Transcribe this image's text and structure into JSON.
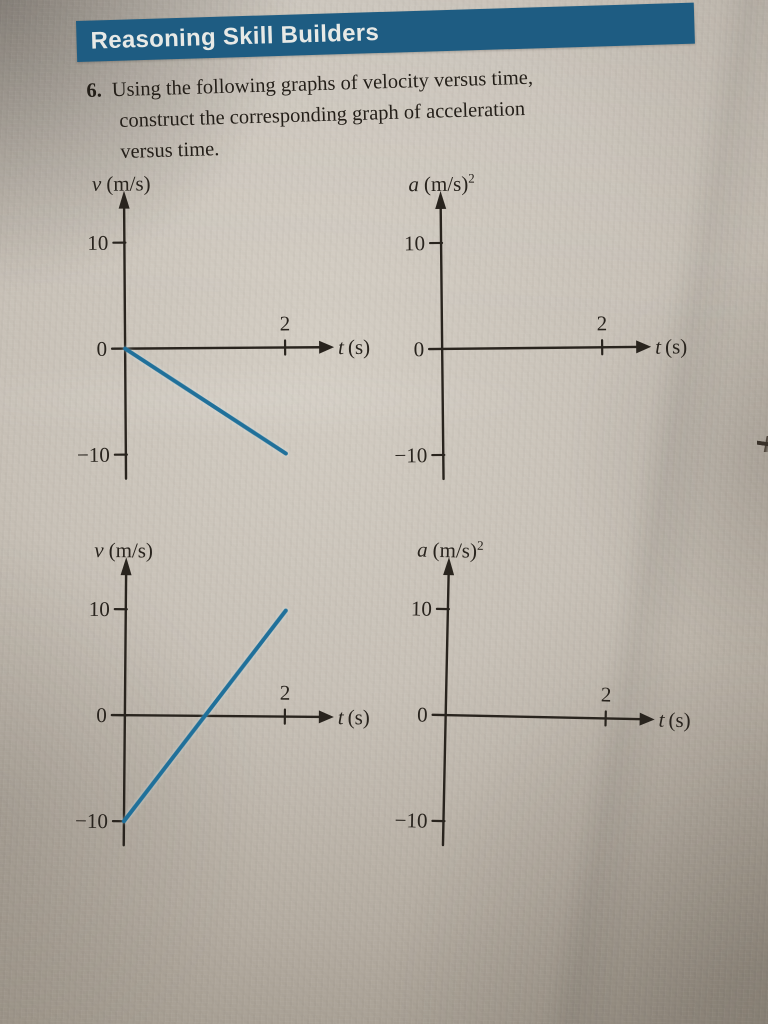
{
  "header": {
    "title": "Reasoning Skill Builders"
  },
  "problem": {
    "number": "6.",
    "text_lines": [
      "Using the following graphs of velocity versus time,",
      "construct the corresponding graph of acceleration",
      "versus time."
    ]
  },
  "colors": {
    "banner": "#1e5c82",
    "plot_line": "#20709a",
    "ink": "#29241e",
    "paper": "#c6bfb5"
  },
  "chart_data": [
    {
      "id": "velocity-time-graph-1",
      "type": "line",
      "ylabel": {
        "var": "v",
        "units": "(m/s)",
        "sup": ""
      },
      "xlabel": {
        "var": "t",
        "units": "(s)"
      },
      "yticks": [
        "10",
        "0",
        "−10"
      ],
      "xticks": [
        "2"
      ],
      "xlim": [
        0,
        2.6
      ],
      "ylim": [
        -13,
        14
      ],
      "grid": false,
      "legend": false,
      "series": [
        {
          "name": "velocity",
          "x": [
            0,
            2
          ],
          "y": [
            0,
            -10
          ]
        }
      ],
      "note": "straight line from (0 s, 0 m/s) down to (2 s, -10 m/s)"
    },
    {
      "id": "acceleration-time-graph-1",
      "type": "line",
      "ylabel": {
        "var": "a",
        "units": "(m/s)",
        "sup": "2"
      },
      "xlabel": {
        "var": "t",
        "units": "(s)"
      },
      "yticks": [
        "10",
        "0",
        "−10"
      ],
      "xticks": [
        "2"
      ],
      "xlim": [
        0,
        2.6
      ],
      "ylim": [
        -13,
        14
      ],
      "grid": false,
      "legend": false,
      "series": [],
      "note": "empty axes for student to construct acceleration graph"
    },
    {
      "id": "velocity-time-graph-2",
      "type": "line",
      "ylabel": {
        "var": "v",
        "units": "(m/s)",
        "sup": ""
      },
      "xlabel": {
        "var": "t",
        "units": "(s)"
      },
      "yticks": [
        "10",
        "0",
        "−10"
      ],
      "xticks": [
        "2"
      ],
      "xlim": [
        0,
        2.6
      ],
      "ylim": [
        -13,
        14
      ],
      "grid": false,
      "legend": false,
      "series": [
        {
          "name": "velocity",
          "x": [
            0,
            2
          ],
          "y": [
            -10,
            10
          ]
        }
      ],
      "note": "straight line from (0 s, -10 m/s) up to (2 s, 10 m/s)"
    },
    {
      "id": "acceleration-time-graph-2",
      "type": "line",
      "ylabel": {
        "var": "a",
        "units": "(m/s)",
        "sup": "2"
      },
      "xlabel": {
        "var": "t",
        "units": "(s)"
      },
      "yticks": [
        "10",
        "0",
        "−10"
      ],
      "xticks": [
        "2"
      ],
      "xlim": [
        0,
        2.6
      ],
      "ylim": [
        -13,
        14
      ],
      "grid": false,
      "legend": false,
      "series": [],
      "note": "empty axes for student to construct acceleration graph"
    }
  ]
}
